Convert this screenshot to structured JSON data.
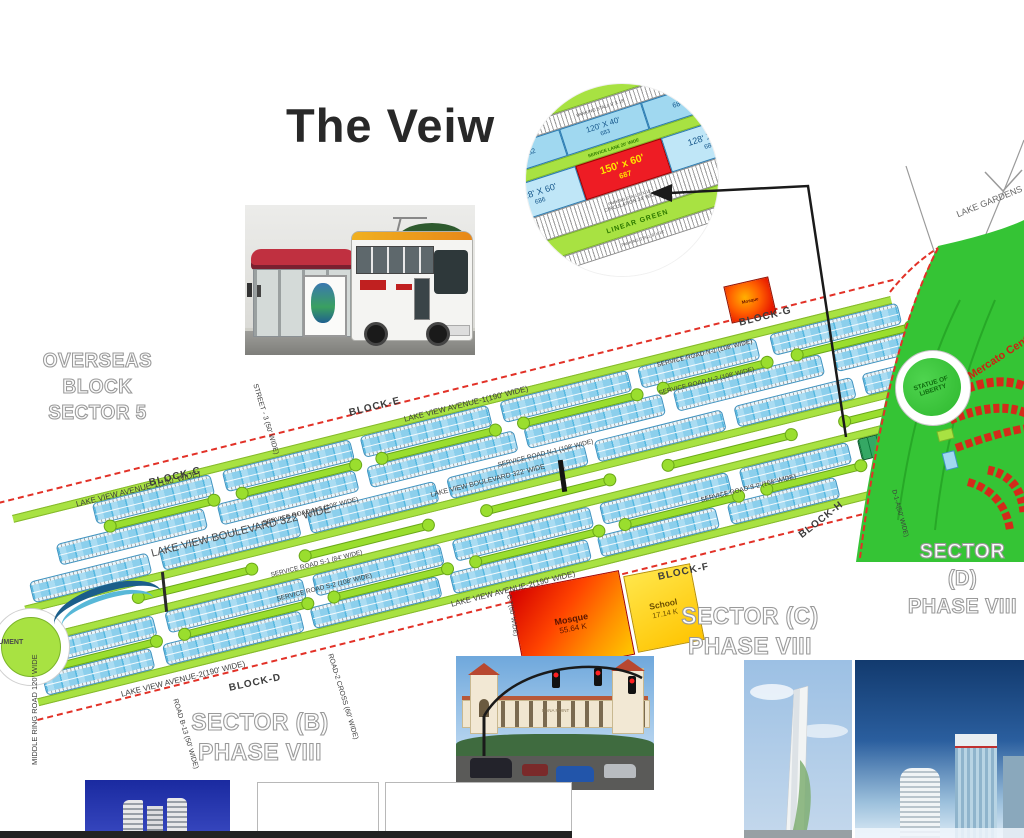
{
  "title": "The Veiw",
  "callout": {
    "parking_stall": "PARKING STALL 8' X 18'",
    "service_lane": "SERVICE LANE 20' WIDE",
    "circulation": "CIRCULATION 24' WIDE",
    "linear_green": "LINEAR GREEN",
    "plots_top": {
      "size": "120' X 40'",
      "left_num": "682",
      "center_num": "683",
      "right_num": "684"
    },
    "plot_left": {
      "size": "128' X 60'",
      "num": "686"
    },
    "plot_center": {
      "size": "150' x 60'",
      "num": "687"
    },
    "plot_right": {
      "size": "128' X 60'",
      "num": "688"
    }
  },
  "sectors": {
    "overseas_line1": "OVERSEAS BLOCK",
    "overseas_line2": "SECTOR 5",
    "b_line1": "SECTOR (B)",
    "b_line2": "PHASE VIII",
    "c_line1": "SECTOR (C)",
    "c_line2": "PHASE VIII",
    "d_line1": "SECTOR (D)",
    "d_line2": "PHASE VIII"
  },
  "blocks": {
    "c": "BLOCK-C",
    "d": "BLOCK-D",
    "e": "BLOCK-E",
    "f": "BLOCK-F",
    "g": "BLOCK-G",
    "h": "BLOCK-H"
  },
  "roads": {
    "avenue1": "LAKE VIEW AVENUE-1(190' WIDE)",
    "avenue2": "LAKE VIEW AVENUE-2(190' WIDE)",
    "boulevard": "LAKE VIEW BOULEVARD 322' WIDE",
    "service_n1": "SERVICE ROAD N-1 (108' WIDE)",
    "service_n2": "SERVICE ROAD N-2 (108' WIDE)",
    "service_n3": "SERVICE ROAD N-3 (108' WIDE)",
    "service_s1": "SERVICE ROAD S-1 (84' WIDE)",
    "service_s2": "SERVICE ROAD S-2 (108' WIDE)",
    "street3": "STREET - 3 (50' WIDE)",
    "c7": "C-7(60' WIDE)",
    "road_b13": "ROAD B-13 (50' WIDE)",
    "road2_cross": "ROAD-2 CROSS (60' WIDE)",
    "d1a": "D-1-A(50' WIDE)",
    "middle_ring": "MIDDLE RING ROAD 120' WIDE"
  },
  "landmarks": {
    "lake_gardens": "LAKE GARDENS",
    "statue_line1": "STATUE OF",
    "statue_line2": "LIBERTY",
    "mercato": "Mercato Center",
    "monument": "MONUMENT",
    "dana_point": "DANA POINT"
  },
  "parcels": {
    "mosque_name": "Mosque",
    "mosque_size": "55.64 K",
    "school_name": "School",
    "school_size": "17.14 K",
    "small_mosque": "Mosque"
  },
  "colors": {
    "boundary_red": "#e23127",
    "plot_blue": "#a9dcf3",
    "linear_green": "#a8e242",
    "park_green": "#35c435",
    "highlight_red": "#ee1c24",
    "school_yellow": "#ffd400"
  }
}
